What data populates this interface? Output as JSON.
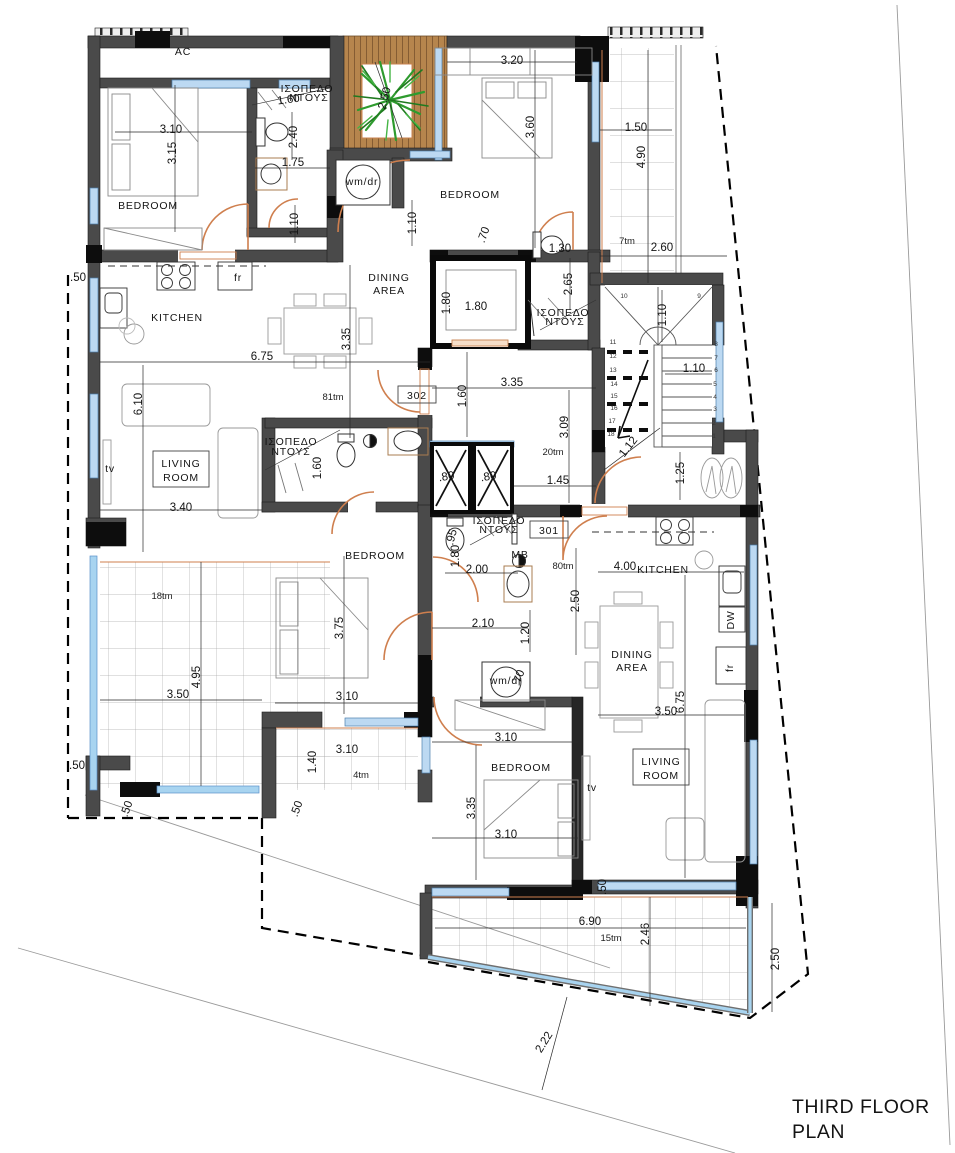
{
  "drawing": {
    "title_line1": "THIRD FLOOR",
    "title_line2": "PLAN"
  },
  "room_labels": [
    {
      "name": "ac-label",
      "text": "AC",
      "x": 183,
      "y": 55,
      "size": 11
    },
    {
      "name": "bedroom-top-left",
      "text": "BEDROOM",
      "x": 148,
      "y": 209
    },
    {
      "name": "kitchen-left",
      "text": "KITCHEN",
      "x": 177,
      "y": 321
    },
    {
      "name": "dining-area-left-1",
      "text": "DINING",
      "x": 389,
      "y": 281
    },
    {
      "name": "dining-area-left-2",
      "text": "AREA",
      "x": 389,
      "y": 294
    },
    {
      "name": "living-room-left-1",
      "text": "LIVING",
      "x": 181,
      "y": 467,
      "box": {
        "x": 153,
        "y": 451,
        "w": 56,
        "h": 36
      }
    },
    {
      "name": "living-room-left-2",
      "text": "ROOM",
      "x": 181,
      "y": 481
    },
    {
      "name": "tv-left",
      "text": "tv",
      "x": 110,
      "y": 472
    },
    {
      "name": "bedroom-top-right",
      "text": "BEDROOM",
      "x": 470,
      "y": 198
    },
    {
      "name": "bedroom-mid-left",
      "text": "BEDROOM",
      "x": 375,
      "y": 559
    },
    {
      "name": "bedroom-bottom",
      "text": "BEDROOM",
      "x": 521,
      "y": 771
    },
    {
      "name": "living-room-right-1",
      "text": "LIVING",
      "x": 661,
      "y": 765,
      "box": {
        "x": 633,
        "y": 749,
        "w": 56,
        "h": 36
      }
    },
    {
      "name": "living-room-right-2",
      "text": "ROOM",
      "x": 661,
      "y": 779
    },
    {
      "name": "tv-right",
      "text": "tv",
      "x": 592,
      "y": 791
    },
    {
      "name": "kitchen-right",
      "text": "KITCHEN",
      "x": 663,
      "y": 573,
      "size": 9.5
    },
    {
      "name": "dining-area-right-1",
      "text": "DINING",
      "x": 632,
      "y": 658
    },
    {
      "name": "dining-area-right-2",
      "text": "AREA",
      "x": 632,
      "y": 671
    },
    {
      "name": "washer-dryer-top",
      "text": "wm/dr",
      "x": 362,
      "y": 185,
      "size": 8
    },
    {
      "name": "washer-dryer-bottom",
      "text": "wm/dr",
      "x": 506,
      "y": 684,
      "size": 8
    },
    {
      "name": "fridge-left",
      "text": "fr",
      "x": 238,
      "y": 281,
      "size": 8
    },
    {
      "name": "fridge-right",
      "text": "fr",
      "x": 733,
      "y": 668,
      "size": 8,
      "rot": -90
    },
    {
      "name": "dishwasher-right",
      "text": "DW",
      "x": 734,
      "y": 620,
      "size": 7,
      "rot": -90
    },
    {
      "name": "level-shower-tl-1",
      "text": "ΙΣΟΠΕΔΟ",
      "x": 307,
      "y": 92,
      "size": 6.5
    },
    {
      "name": "level-shower-tl-2",
      "text": "ΝΤΟΥΣ",
      "x": 309,
      "y": 101,
      "size": 6.5
    },
    {
      "name": "level-shower-tr-1",
      "text": "ΙΣΟΠΕΔΟ",
      "x": 563,
      "y": 316,
      "size": 6.5
    },
    {
      "name": "level-shower-tr-2",
      "text": "ΝΤΟΥΣ",
      "x": 565,
      "y": 325,
      "size": 6.5
    },
    {
      "name": "level-shower-ml-1",
      "text": "ΙΣΟΠΕΔΟ",
      "x": 291,
      "y": 445,
      "size": 6.5
    },
    {
      "name": "level-shower-ml-2",
      "text": "ΝΤΟΥΣ",
      "x": 291,
      "y": 455,
      "size": 6.5
    },
    {
      "name": "level-shower-mr-1",
      "text": "ΙΣΟΠΕΔΟ",
      "x": 499,
      "y": 524,
      "size": 6.5
    },
    {
      "name": "level-shower-mr-2",
      "text": "ΝΤΟΥΣ",
      "x": 499,
      "y": 533,
      "size": 6.5
    },
    {
      "name": "mb-label",
      "text": "ΜΒ",
      "x": 520,
      "y": 558,
      "size": 6
    },
    {
      "name": "apartment-302",
      "text": "302",
      "x": 417,
      "y": 399,
      "size": 11,
      "box": {
        "x": 398,
        "y": 386,
        "w": 38,
        "h": 17
      }
    },
    {
      "name": "apartment-301",
      "text": "301",
      "x": 549,
      "y": 534,
      "size": 11,
      "box": {
        "x": 530,
        "y": 521,
        "w": 38,
        "h": 17
      }
    }
  ],
  "area_labels": [
    {
      "text": "81tm",
      "x": 333,
      "y": 400
    },
    {
      "text": "20tm",
      "x": 553,
      "y": 455
    },
    {
      "text": "80tm",
      "x": 563,
      "y": 569
    },
    {
      "text": "7tm",
      "x": 627,
      "y": 244
    },
    {
      "text": "18tm",
      "x": 162,
      "y": 599
    },
    {
      "text": "4tm",
      "x": 361,
      "y": 778
    },
    {
      "text": "15tm",
      "x": 611,
      "y": 941
    }
  ],
  "dimension_labels": [
    {
      "text": "3.10",
      "x": 171,
      "y": 133
    },
    {
      "text": "3.15",
      "x": 176,
      "y": 153,
      "rot": -90
    },
    {
      "text": "1.60",
      "x": 289,
      "y": 103,
      "rot": -8
    },
    {
      "text": "2.40",
      "x": 297,
      "y": 137,
      "rot": -90
    },
    {
      "text": "1.75",
      "x": 293,
      "y": 166
    },
    {
      "text": "1.10",
      "x": 298,
      "y": 224,
      "rot": -90
    },
    {
      "text": "1.10",
      "x": 416,
      "y": 223,
      "rot": -90
    },
    {
      "text": "2.50",
      "x": 388,
      "y": 99,
      "rot": -75
    },
    {
      "text": "3.20",
      "x": 512,
      "y": 64
    },
    {
      "text": "3.60",
      "x": 534,
      "y": 127,
      "rot": -90
    },
    {
      "text": ".70",
      "x": 487,
      "y": 236,
      "rot": -70
    },
    {
      "text": "1.30",
      "x": 560,
      "y": 252
    },
    {
      "text": "1.50",
      "x": 636,
      "y": 131
    },
    {
      "text": "4.90",
      "x": 645,
      "y": 157,
      "rot": -90
    },
    {
      "text": "2.60",
      "x": 662,
      "y": 251
    },
    {
      "text": "2.65",
      "x": 572,
      "y": 284,
      "rot": -90
    },
    {
      "text": "1.80",
      "x": 450,
      "y": 303,
      "rot": -90
    },
    {
      "text": "1.80",
      "x": 476,
      "y": 310
    },
    {
      "text": "1.10",
      "x": 666,
      "y": 315,
      "rot": -90
    },
    {
      "text": "1.10",
      "x": 694,
      "y": 372
    },
    {
      "text": "1.12",
      "x": 631,
      "y": 449,
      "rot": -52
    },
    {
      "text": "1.25",
      "x": 684,
      "y": 473,
      "rot": -90
    },
    {
      "text": ".50",
      "x": 78,
      "y": 281
    },
    {
      "text": "6.75",
      "x": 262,
      "y": 360
    },
    {
      "text": "3.35",
      "x": 350,
      "y": 339,
      "rot": -90
    },
    {
      "text": "6.10",
      "x": 142,
      "y": 404,
      "rot": -90
    },
    {
      "text": "3.40",
      "x": 181,
      "y": 511
    },
    {
      "text": "1.60",
      "x": 321,
      "y": 468,
      "rot": -90
    },
    {
      "text": "3.35",
      "x": 512,
      "y": 386
    },
    {
      "text": "1.60",
      "x": 466,
      "y": 396,
      "rot": -90
    },
    {
      "text": "3.09",
      "x": 568,
      "y": 427,
      "rot": -90
    },
    {
      "text": "1.45",
      "x": 558,
      "y": 484
    },
    {
      "text": ".80",
      "x": 447,
      "y": 480,
      "rot": -10
    },
    {
      "text": ".80",
      "x": 489,
      "y": 480,
      "rot": -10
    },
    {
      "text": ".95",
      "x": 455,
      "y": 538,
      "rot": -75
    },
    {
      "text": "1.80",
      "x": 459,
      "y": 556,
      "rot": -90
    },
    {
      "text": "2.00",
      "x": 477,
      "y": 573
    },
    {
      "text": "2.10",
      "x": 483,
      "y": 627
    },
    {
      "text": "1.20",
      "x": 529,
      "y": 633,
      "rot": -90
    },
    {
      "text": ".70",
      "x": 522,
      "y": 679,
      "rot": -70
    },
    {
      "text": "2.50",
      "x": 579,
      "y": 601,
      "rot": -90
    },
    {
      "text": "4.00",
      "x": 625,
      "y": 570
    },
    {
      "text": "3.50",
      "x": 666,
      "y": 715
    },
    {
      "text": "6.75",
      "x": 684,
      "y": 702,
      "rot": -90
    },
    {
      "text": "3.75",
      "x": 343,
      "y": 628,
      "rot": -90
    },
    {
      "text": "3.10",
      "x": 347,
      "y": 700
    },
    {
      "text": "3.10",
      "x": 506,
      "y": 741
    },
    {
      "text": "3.35",
      "x": 475,
      "y": 808,
      "rot": -90
    },
    {
      "text": "3.10",
      "x": 506,
      "y": 838
    },
    {
      "text": "3.10",
      "x": 347,
      "y": 753
    },
    {
      "text": "1.40",
      "x": 316,
      "y": 762,
      "rot": -90
    },
    {
      "text": ".50",
      "x": 77,
      "y": 769
    },
    {
      "text": ".50",
      "x": 130,
      "y": 810,
      "rot": -70
    },
    {
      "text": ".50",
      "x": 300,
      "y": 810,
      "rot": -70
    },
    {
      "text": "3.50",
      "x": 178,
      "y": 698
    },
    {
      "text": "4.95",
      "x": 200,
      "y": 677,
      "rot": -90
    },
    {
      "text": ".50",
      "x": 606,
      "y": 887,
      "rot": -90
    },
    {
      "text": "6.90",
      "x": 590,
      "y": 925
    },
    {
      "text": "2.46",
      "x": 649,
      "y": 934,
      "rot": -90
    },
    {
      "text": "2.50",
      "x": 779,
      "y": 959,
      "rot": -90
    },
    {
      "text": "2.22",
      "x": 547,
      "y": 1044,
      "rot": -58
    }
  ],
  "stair_step_numbers": [
    {
      "n": "10",
      "x": 624,
      "y": 298
    },
    {
      "n": "9",
      "x": 699,
      "y": 298
    },
    {
      "n": "11",
      "x": 613,
      "y": 344
    },
    {
      "n": "12",
      "x": 613,
      "y": 358
    },
    {
      "n": "13",
      "x": 613,
      "y": 372
    },
    {
      "n": "14",
      "x": 614,
      "y": 386
    },
    {
      "n": "15",
      "x": 614,
      "y": 398
    },
    {
      "n": "16",
      "x": 614,
      "y": 410
    },
    {
      "n": "17",
      "x": 612,
      "y": 423
    },
    {
      "n": "18",
      "x": 611,
      "y": 436
    },
    {
      "n": "8",
      "x": 716,
      "y": 346
    },
    {
      "n": "7",
      "x": 716,
      "y": 360
    },
    {
      "n": "6",
      "x": 716,
      "y": 372
    },
    {
      "n": "5",
      "x": 715,
      "y": 386
    },
    {
      "n": "4",
      "x": 715,
      "y": 399
    },
    {
      "n": "3",
      "x": 715,
      "y": 411
    },
    {
      "n": "2",
      "x": 714,
      "y": 425
    },
    {
      "n": "1",
      "x": 714,
      "y": 438
    }
  ],
  "colors": {
    "wall_gray": "#4a4a4a",
    "pier_black": "#0d0d0d",
    "window_blue": "#bcd9f2",
    "balustrade_blue": "#a8d4f0",
    "door_orange": "#cf7f4e",
    "wood_brown": "#b6854d",
    "plant_green": "#2e9b2e"
  }
}
